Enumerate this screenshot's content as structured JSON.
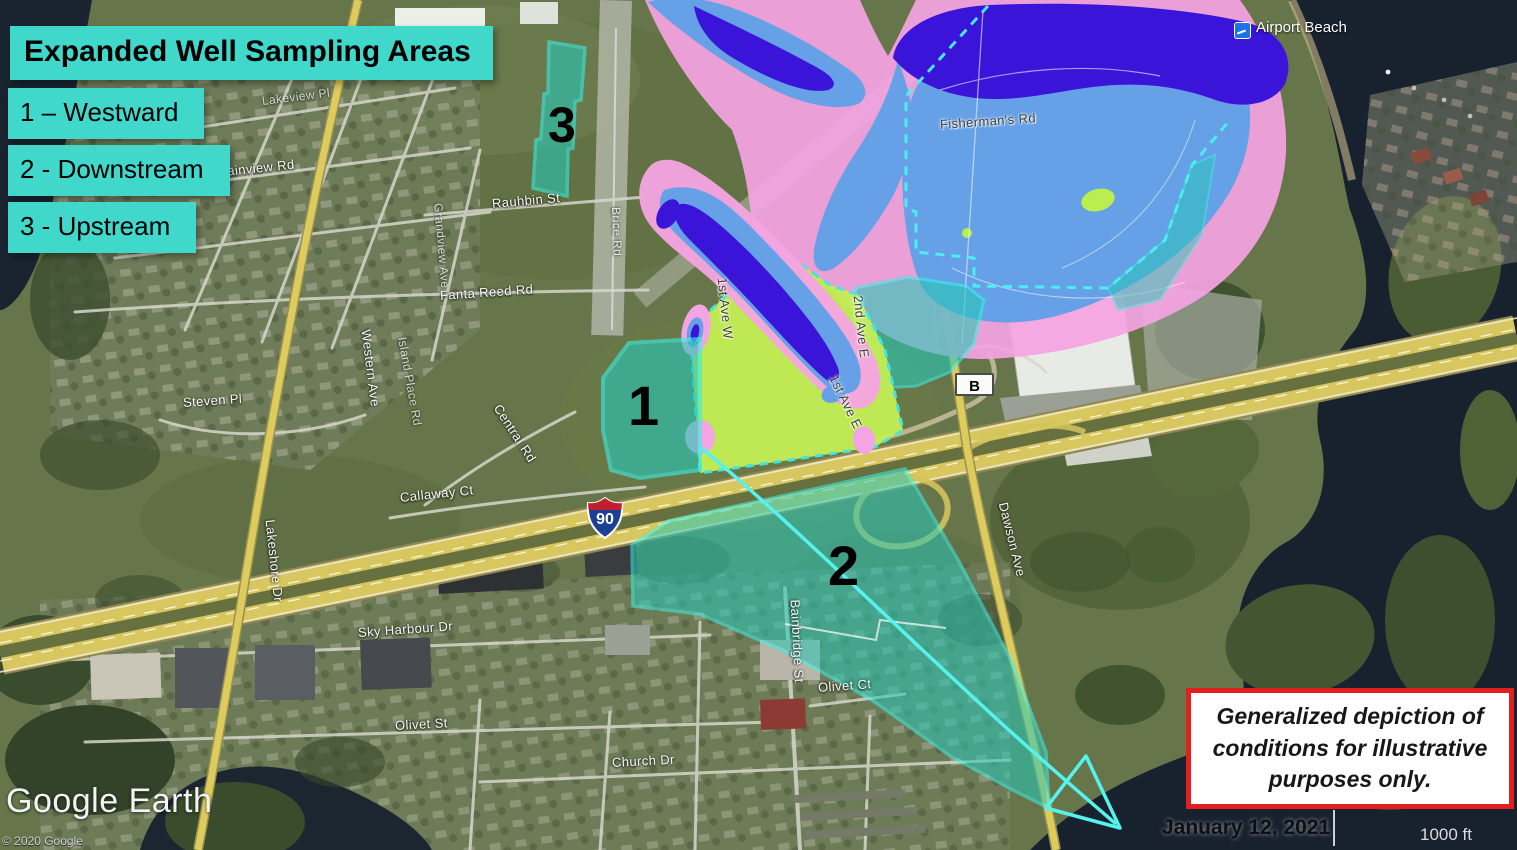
{
  "title": "Expanded Well Sampling Areas",
  "legend": {
    "background_color": "#41D8CC",
    "items": [
      {
        "label": "1 – Westward"
      },
      {
        "label": "2 - Downstream"
      },
      {
        "label": "3 - Upstream"
      }
    ]
  },
  "sampling_areas": [
    {
      "number": "1",
      "name": "Westward"
    },
    {
      "number": "2",
      "name": "Downstream"
    },
    {
      "number": "3",
      "name": "Upstream"
    }
  ],
  "map": {
    "poi_label": "Airport Beach",
    "route_markers": {
      "interstate": "90",
      "county": "B"
    },
    "road_labels": [
      {
        "text": "Lakeview Pl"
      },
      {
        "text": "Plainview Rd"
      },
      {
        "text": "Rauhbin St"
      },
      {
        "text": "Grandview Ave"
      },
      {
        "text": "Fanta Reed Rd"
      },
      {
        "text": "Steven Pl"
      },
      {
        "text": "Western Ave"
      },
      {
        "text": "Island Place Rd"
      },
      {
        "text": "Central Rd"
      },
      {
        "text": "Callaway Ct"
      },
      {
        "text": "Lakeshore Dr"
      },
      {
        "text": "Sky Harbour Dr"
      },
      {
        "text": "Olivet St"
      },
      {
        "text": "Church Dr"
      },
      {
        "text": "Bainbridge St"
      },
      {
        "text": "Olivet Ct"
      },
      {
        "text": "Dawson Ave"
      },
      {
        "text": "1st Ave W"
      },
      {
        "text": "2nd Ave E"
      },
      {
        "text": "1st Ave E"
      },
      {
        "text": "Fisherman's Rd"
      },
      {
        "text": "Brice Rd"
      }
    ]
  },
  "overlay_colors": {
    "plume_outer_pink": "#F4A4E2",
    "plume_mid_blue": "#66A0E6",
    "plume_core_dark_blue": "#3A14D8",
    "sampling_area_teal": "#27C8B8",
    "sampling_area_border_cyan": "#38F0E6",
    "highlight_green": "#C3EF55"
  },
  "disclaimer": "Generalized depiction of conditions for illustrative purposes only.",
  "footer": {
    "date": "January 12, 2021",
    "scale_label": "1000 ft",
    "logo": "Google Earth",
    "copyright": "© 2020 Google"
  }
}
